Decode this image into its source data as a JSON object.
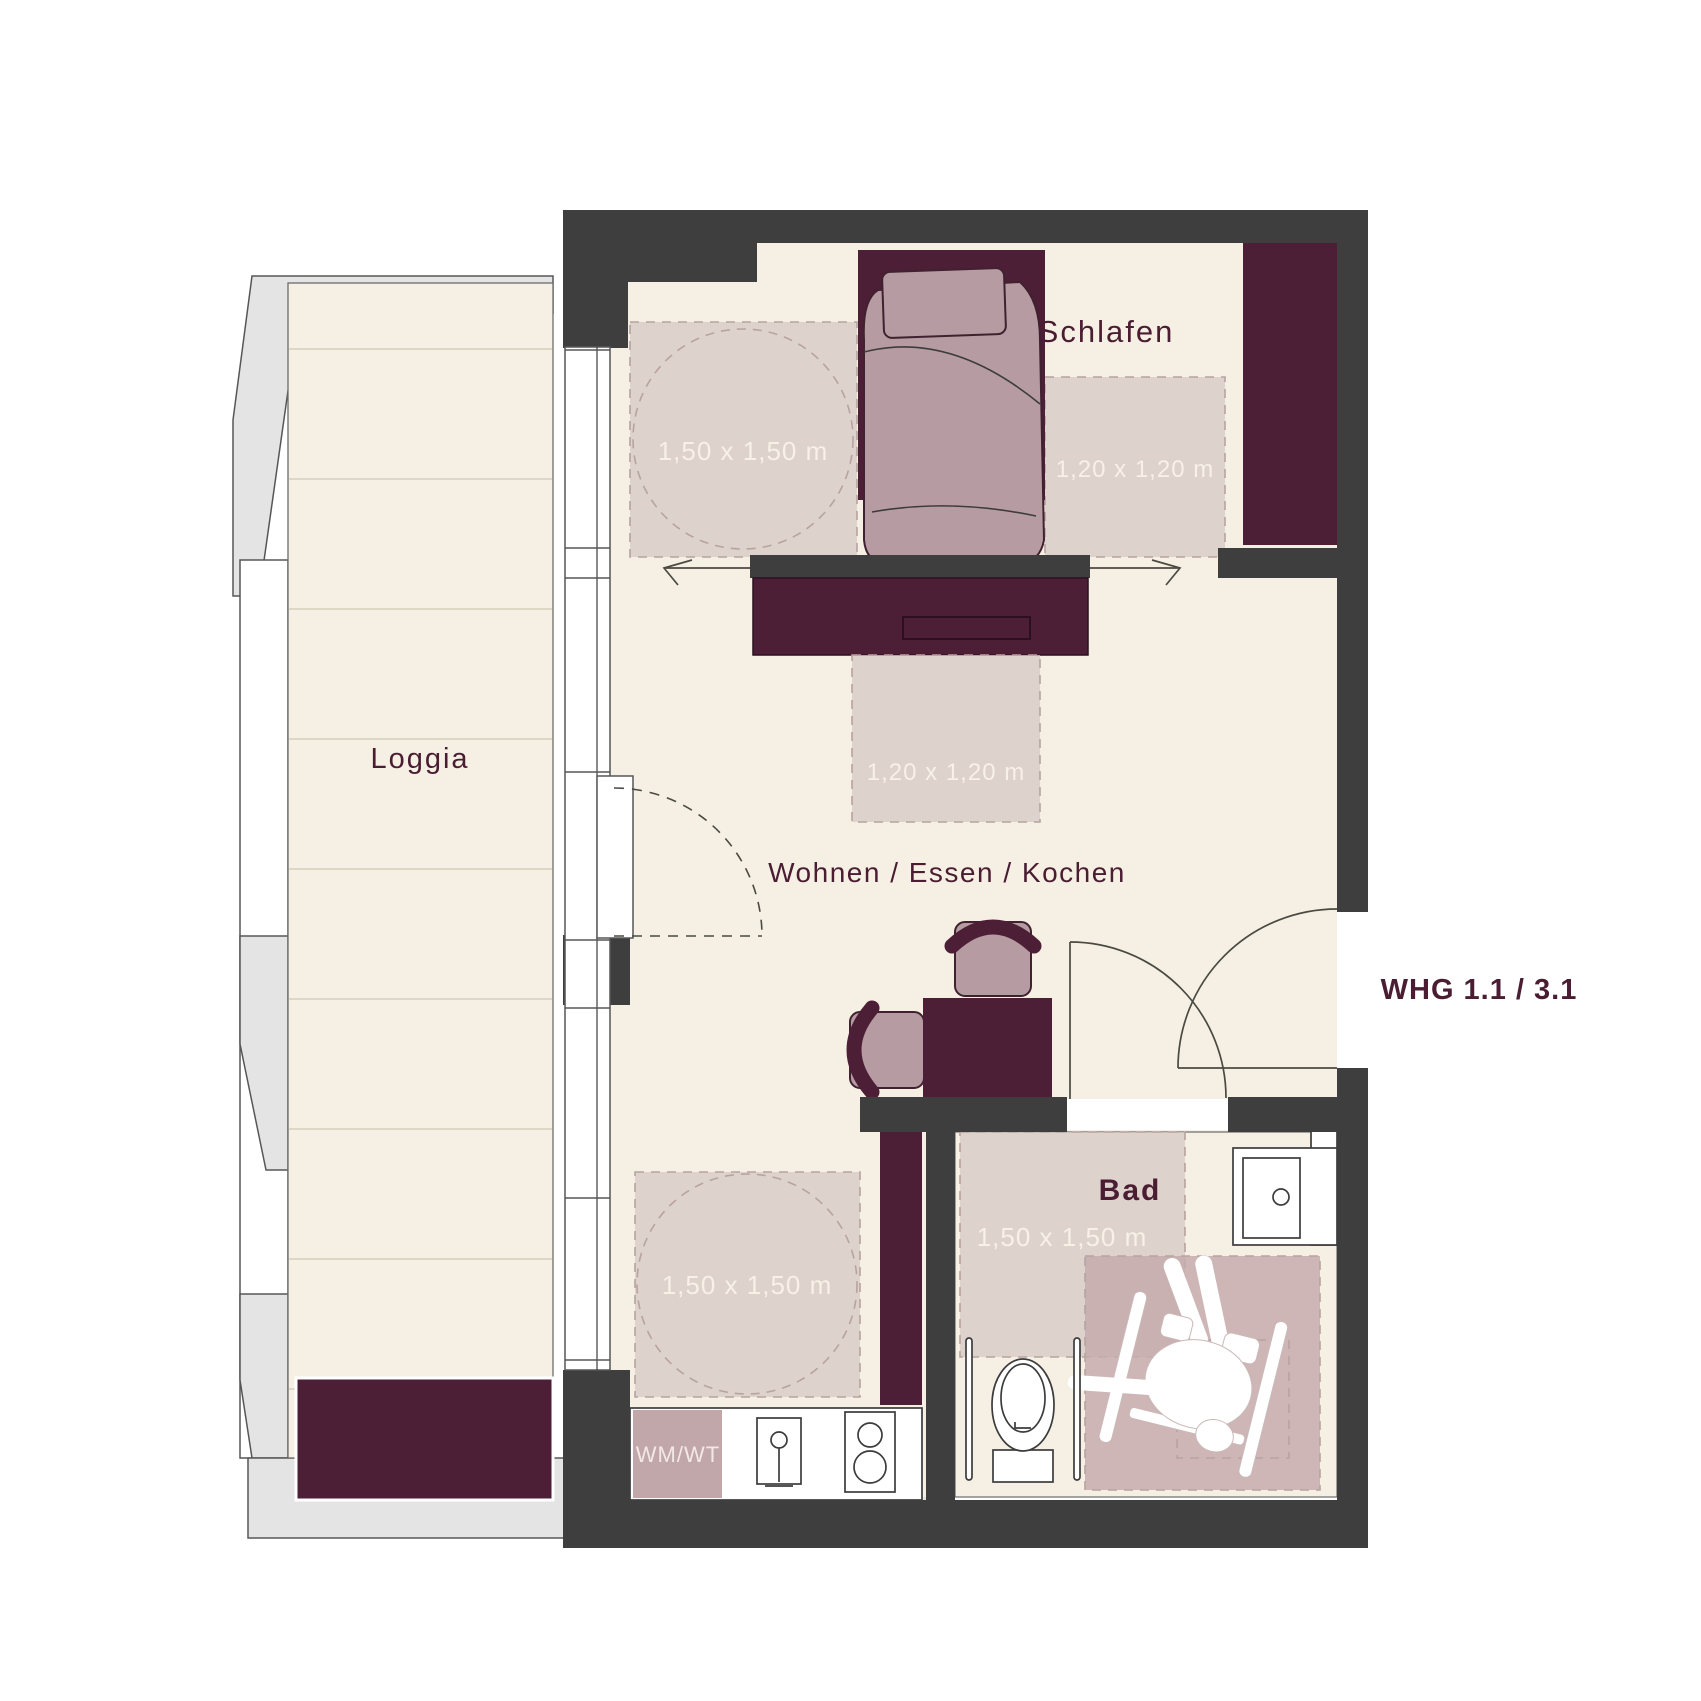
{
  "plan": {
    "apartment_label": "WHG 1.1 / 3.1",
    "rooms": {
      "loggia": "Loggia",
      "sleeping": "Schlafen",
      "living": "Wohnen / Essen / Kochen",
      "bath": "Bad"
    },
    "clearances": {
      "sleeping_turning_circle": "1,50 x 1,50 m",
      "sleeping_bedside": "1,20 x 1,20 m",
      "living_passage": "1,20 x 1,20 m",
      "kitchen_turning_circle": "1,50 x 1,50 m",
      "bath_turning_circle": "1,50 x 1,50 m"
    },
    "appliances": {
      "washer_dryer": "WM/WT"
    },
    "colors": {
      "wall": "#3e3e3e",
      "floor": "#f5f0e3",
      "accent_purple": "#4d1f37",
      "clearance_pink": "#d5c6c4",
      "furniture_mauve": "#b69ca2",
      "balcony_gray": "#e4e4e4"
    }
  }
}
